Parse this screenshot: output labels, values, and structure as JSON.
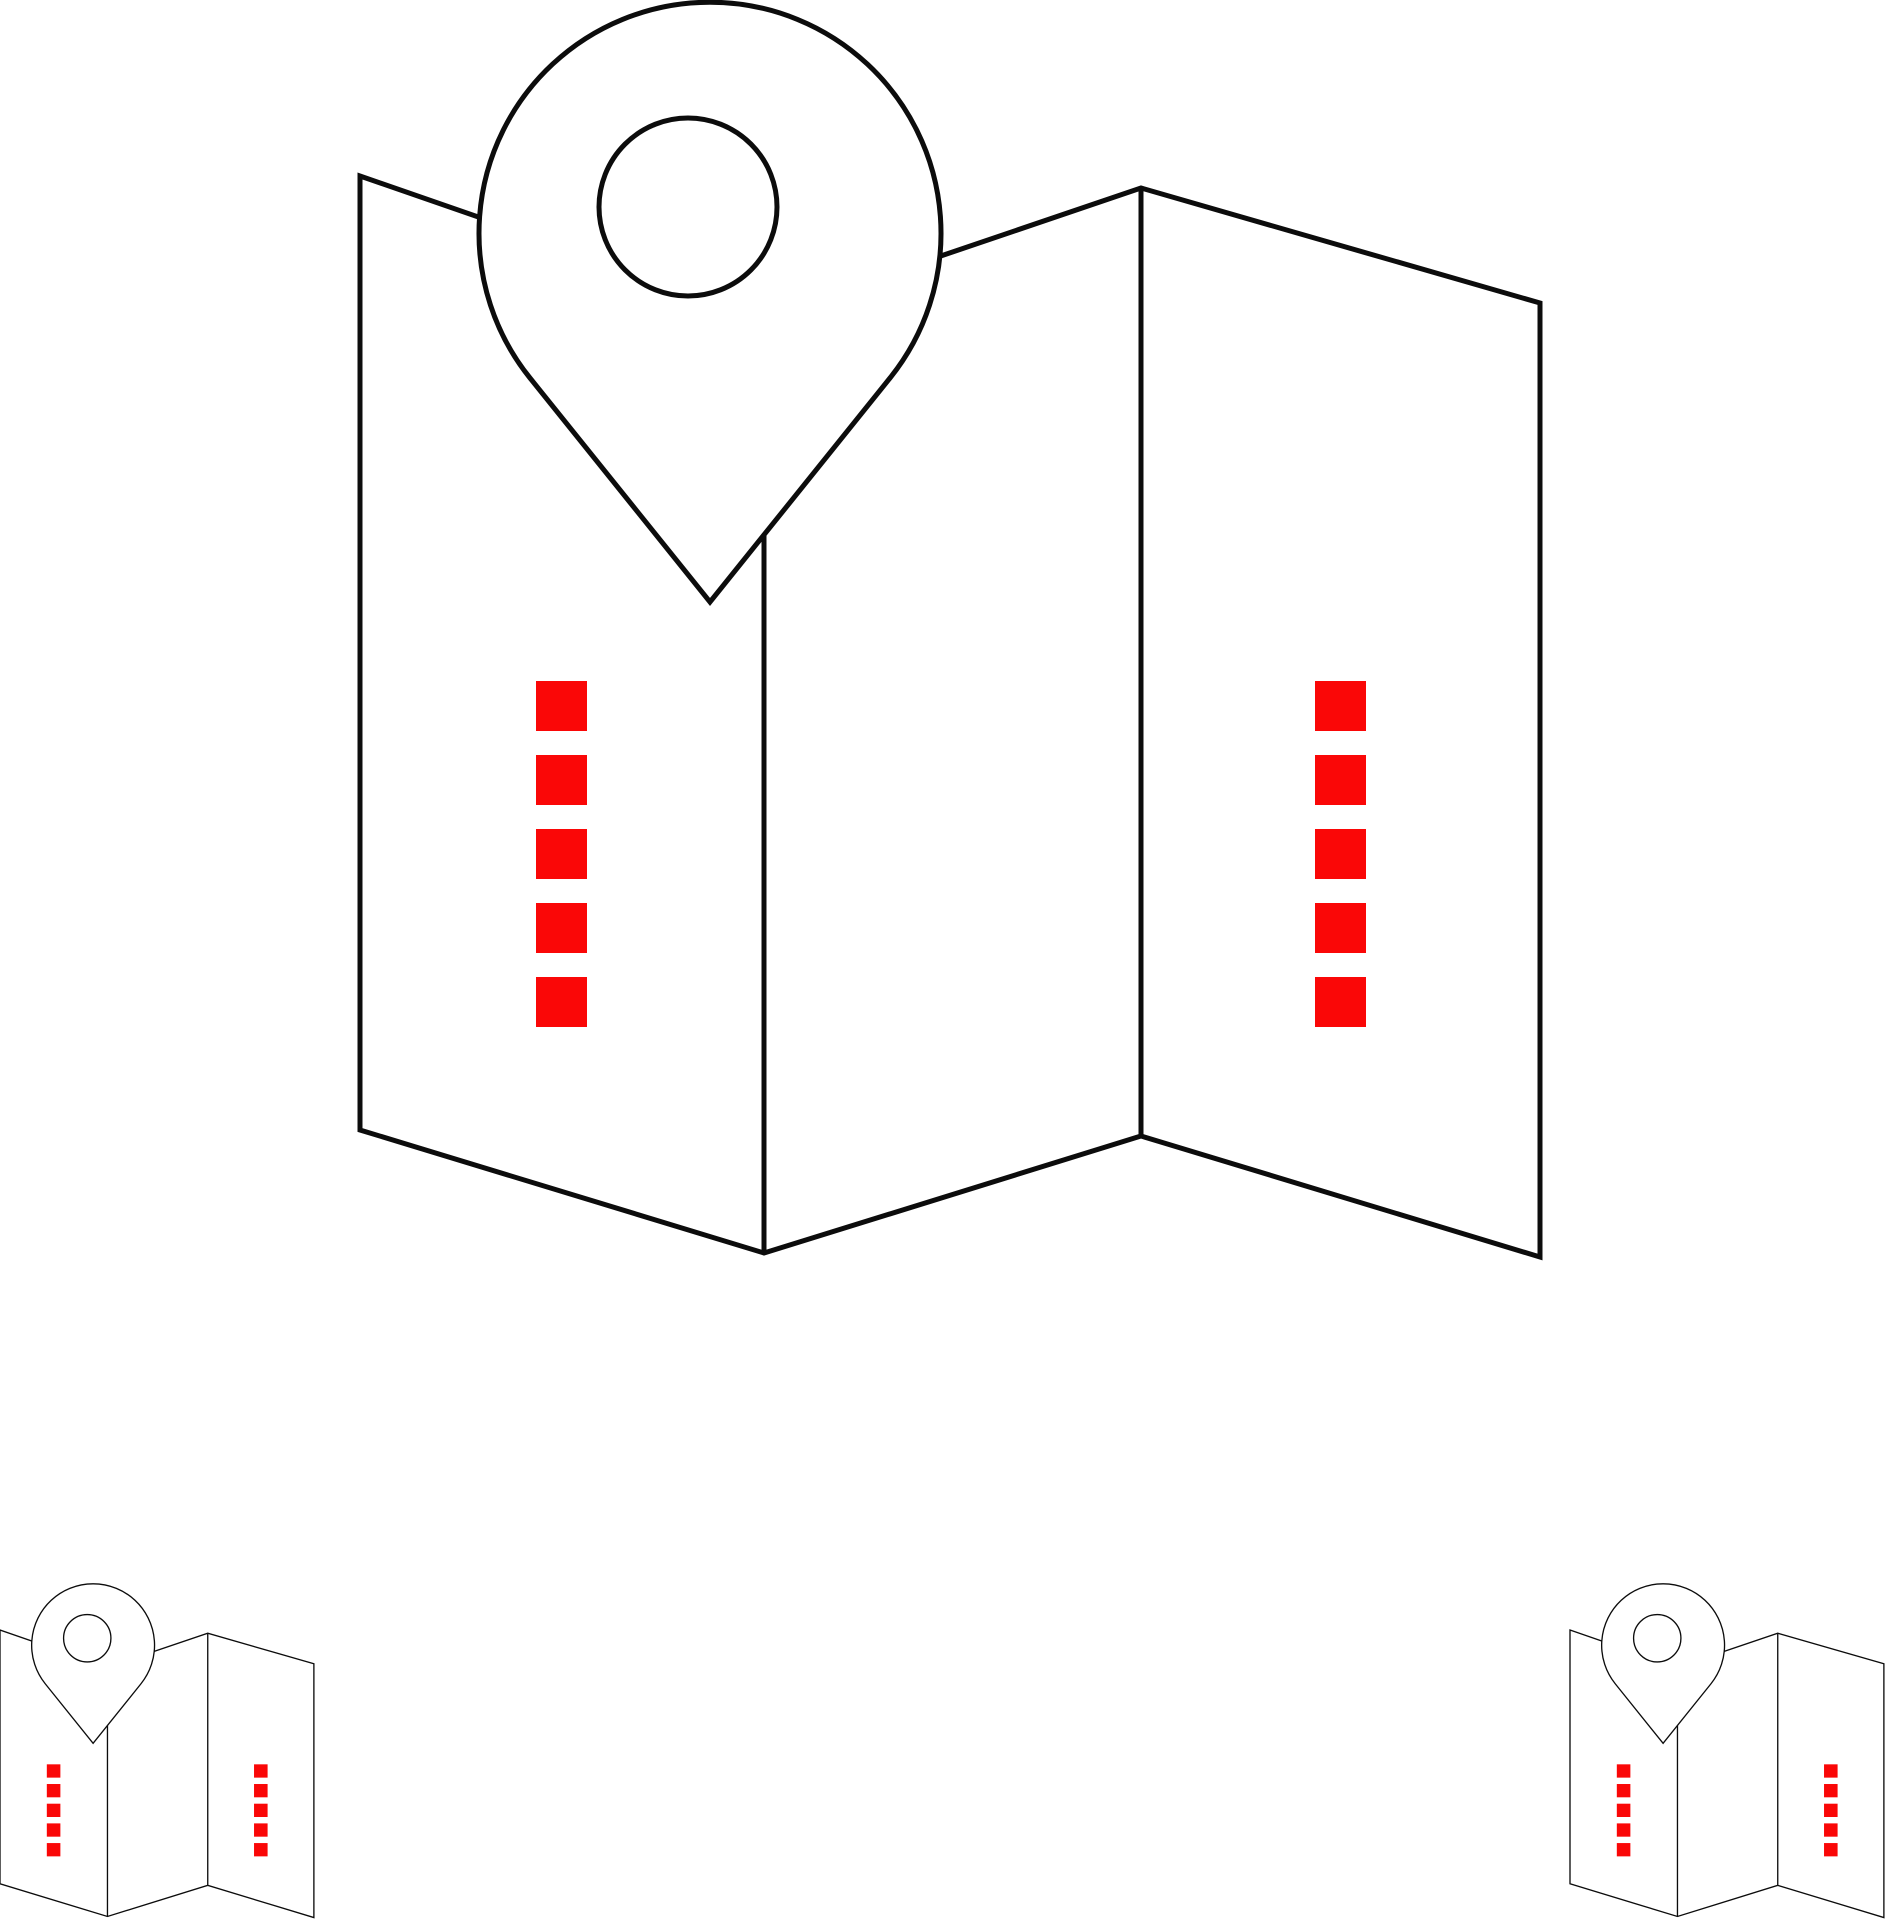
{
  "canvas": {
    "width": 1887,
    "height": 1920,
    "background_color": "#ffffff"
  },
  "art": {
    "description": "folded-map-with-location-pin-icon-sheet",
    "stroke_color": "#0c0c0c",
    "fill_color": "#ffffff",
    "accent_color": "#fa0707",
    "stroke_width": 5,
    "ref_point": [
      360,
      176
    ],
    "map_outline": [
      [
        360,
        176
      ],
      [
        764,
        316
      ],
      [
        1141,
        188
      ],
      [
        1540,
        303
      ],
      [
        1540,
        1257
      ],
      [
        1141,
        1136
      ],
      [
        764,
        1253
      ],
      [
        360,
        1130
      ]
    ],
    "fold_lines": [
      {
        "x": 764,
        "y1": 316,
        "y2": 1253
      },
      {
        "x": 1141,
        "y1": 188,
        "y2": 1136
      }
    ],
    "pin": {
      "outer_circle": {
        "cx": 710,
        "cy": 233,
        "r": 231
      },
      "tangent": {
        "x1": 530,
        "x2": 890,
        "y": 378
      },
      "tip": {
        "x": 710,
        "y": 602
      },
      "inner_circle": {
        "cx": 688,
        "cy": 207,
        "r": 89
      }
    },
    "marker_squares": {
      "columns_x": [
        536,
        1315
      ],
      "rows_y": [
        681,
        755,
        829,
        903,
        977
      ],
      "width": 51,
      "height": 50
    },
    "instances": [
      {
        "id": "main",
        "anchor_x": 360,
        "anchor_y": 176,
        "scale": 1
      },
      {
        "id": "small-left",
        "anchor_x": 0,
        "anchor_y": 1630,
        "scale": 0.266
      },
      {
        "id": "small-right",
        "anchor_x": 1570,
        "anchor_y": 1630,
        "scale": 0.266
      }
    ]
  }
}
